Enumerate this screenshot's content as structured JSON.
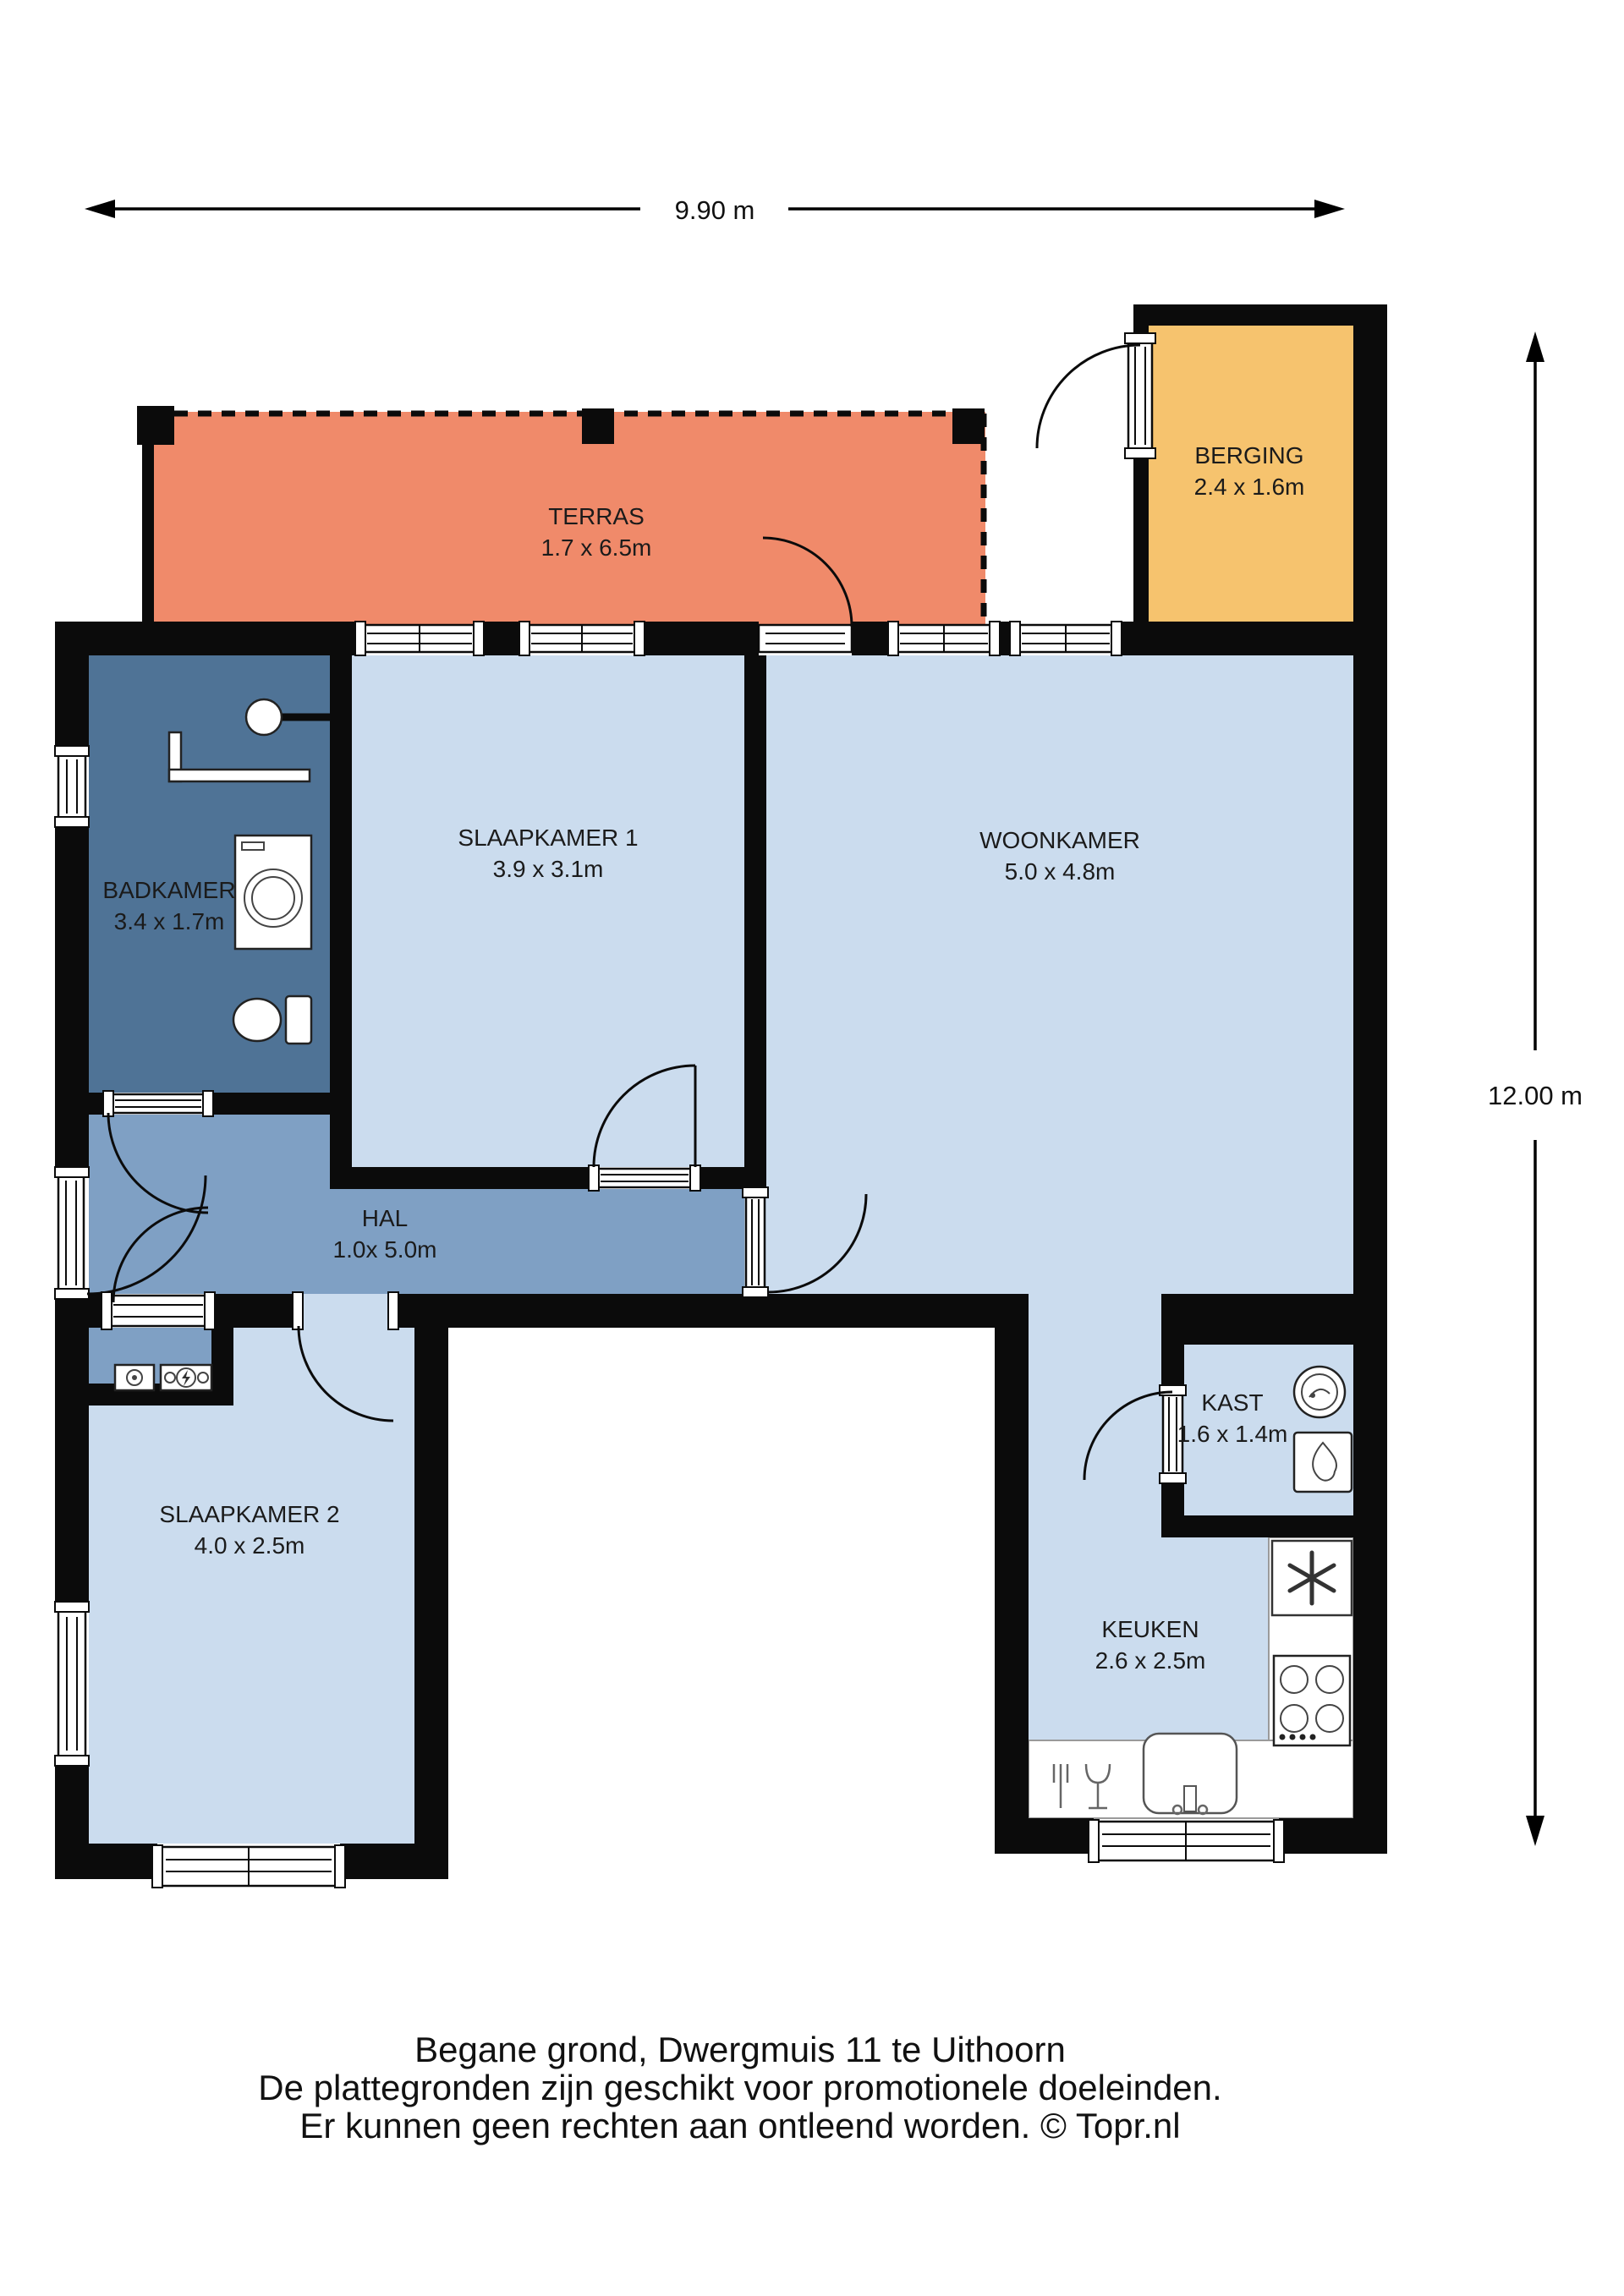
{
  "plan": {
    "dimensions": {
      "width": "9.90 m",
      "height": "12.00 m"
    },
    "rooms": [
      {
        "id": "terras",
        "name": "TERRAS",
        "size": "1.7 x 6.5m"
      },
      {
        "id": "berging",
        "name": "BERGING",
        "size": "2.4 x 1.6m"
      },
      {
        "id": "badkamer",
        "name": "BADKAMER",
        "size": "3.4 x 1.7m"
      },
      {
        "id": "slaapkamer1",
        "name": "SLAAPKAMER 1",
        "size": "3.9 x 3.1m"
      },
      {
        "id": "woonkamer",
        "name": "WOONKAMER",
        "size": "5.0 x 4.8m"
      },
      {
        "id": "hal",
        "name": "HAL",
        "size": "1.0x 5.0m"
      },
      {
        "id": "slaapkamer2",
        "name": "SLAAPKAMER 2",
        "size": "4.0 x 2.5m"
      },
      {
        "id": "kast",
        "name": "KAST",
        "size": "1.6 x 1.4m"
      },
      {
        "id": "keuken",
        "name": "KEUKEN",
        "size": "2.6 x 2.5m"
      }
    ],
    "colors": {
      "wall": "#0b0b0b",
      "terras": "#F08A6A",
      "berging": "#F6C36E",
      "room_light": "#CBDCEE",
      "hal": "#7FA0C4",
      "badkamer": "#4F7396",
      "background": "#FFFFFF"
    },
    "footer": {
      "line1": "Begane grond, Dwergmuis 11 te Uithoorn",
      "line2": "De plattegronden zijn geschikt voor promotionele doeleinden.",
      "line3": "Er kunnen geen rechten aan ontleend worden. © Topr.nl"
    }
  }
}
